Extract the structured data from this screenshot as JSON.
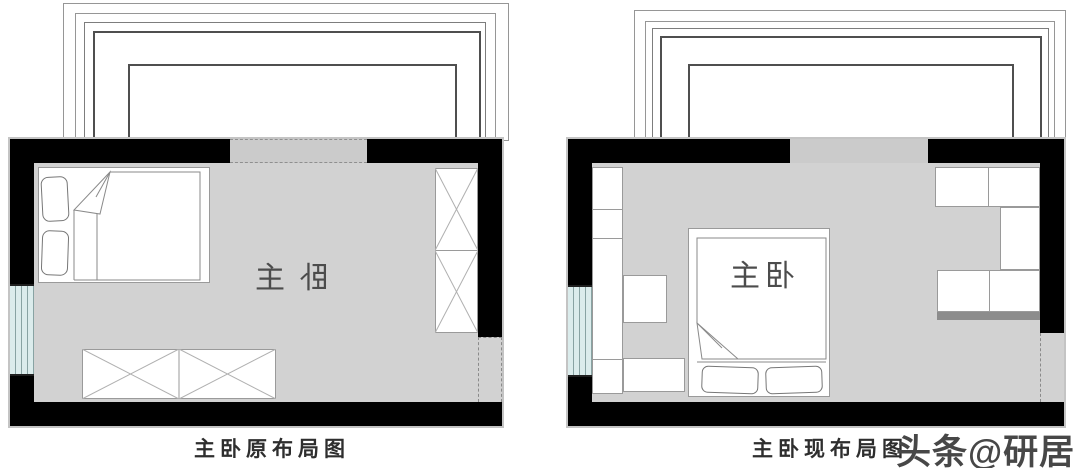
{
  "left_plan": {
    "caption": "主卧原布局图",
    "room_label_parts": [
      "主",
      "卧"
    ]
  },
  "right_plan": {
    "caption": "主卧现布局图",
    "room_label": "主卧"
  },
  "watermark": "头条@研居",
  "colors": {
    "wall": "#000000",
    "floor": "#d2d2d2",
    "opening": "#cbcbcb",
    "window": "#dbecec",
    "outline": "#c4c4c4",
    "cabinet_accent": "#8c8c8c",
    "text": "#4c4c4c"
  }
}
